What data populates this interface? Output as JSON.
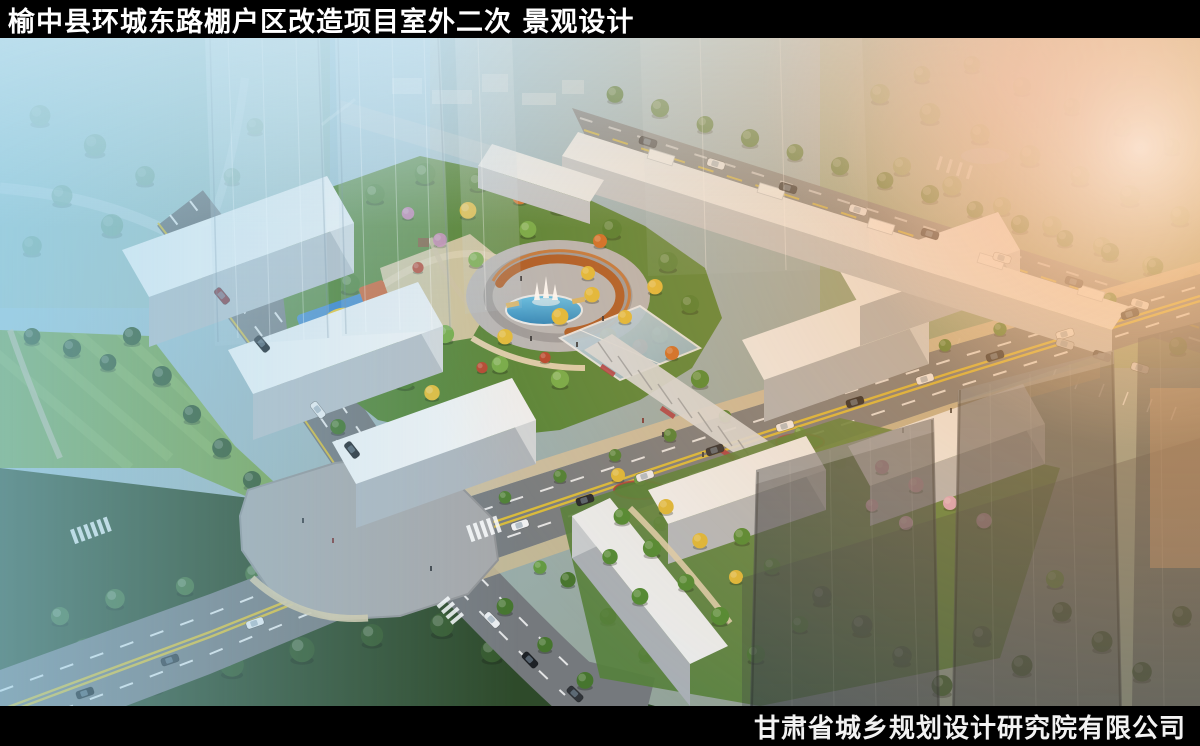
{
  "header": {
    "title": "榆中县环城东路棚户区改造项目室外二次 景观设计"
  },
  "footer": {
    "company": "甘肃省城乡规划设计研究院有限公司"
  },
  "scene": {
    "kind": "aerial landscape design rendering",
    "palette": {
      "bar_background": "#000000",
      "title_text": "#ffffff",
      "sky_haze_cyan": "#a9d9ee",
      "sunset_glow_orange": "#f39642",
      "foliage_green": "#57863a",
      "autumn_yellow": "#e2bd3b",
      "pergola_rust": "#ad5d28",
      "fountain_pool_blue": "#49b0e4",
      "building_white": "#eef1f3",
      "road_asphalt": "#787d81",
      "lane_line_yellow": "#e3c334"
    }
  }
}
